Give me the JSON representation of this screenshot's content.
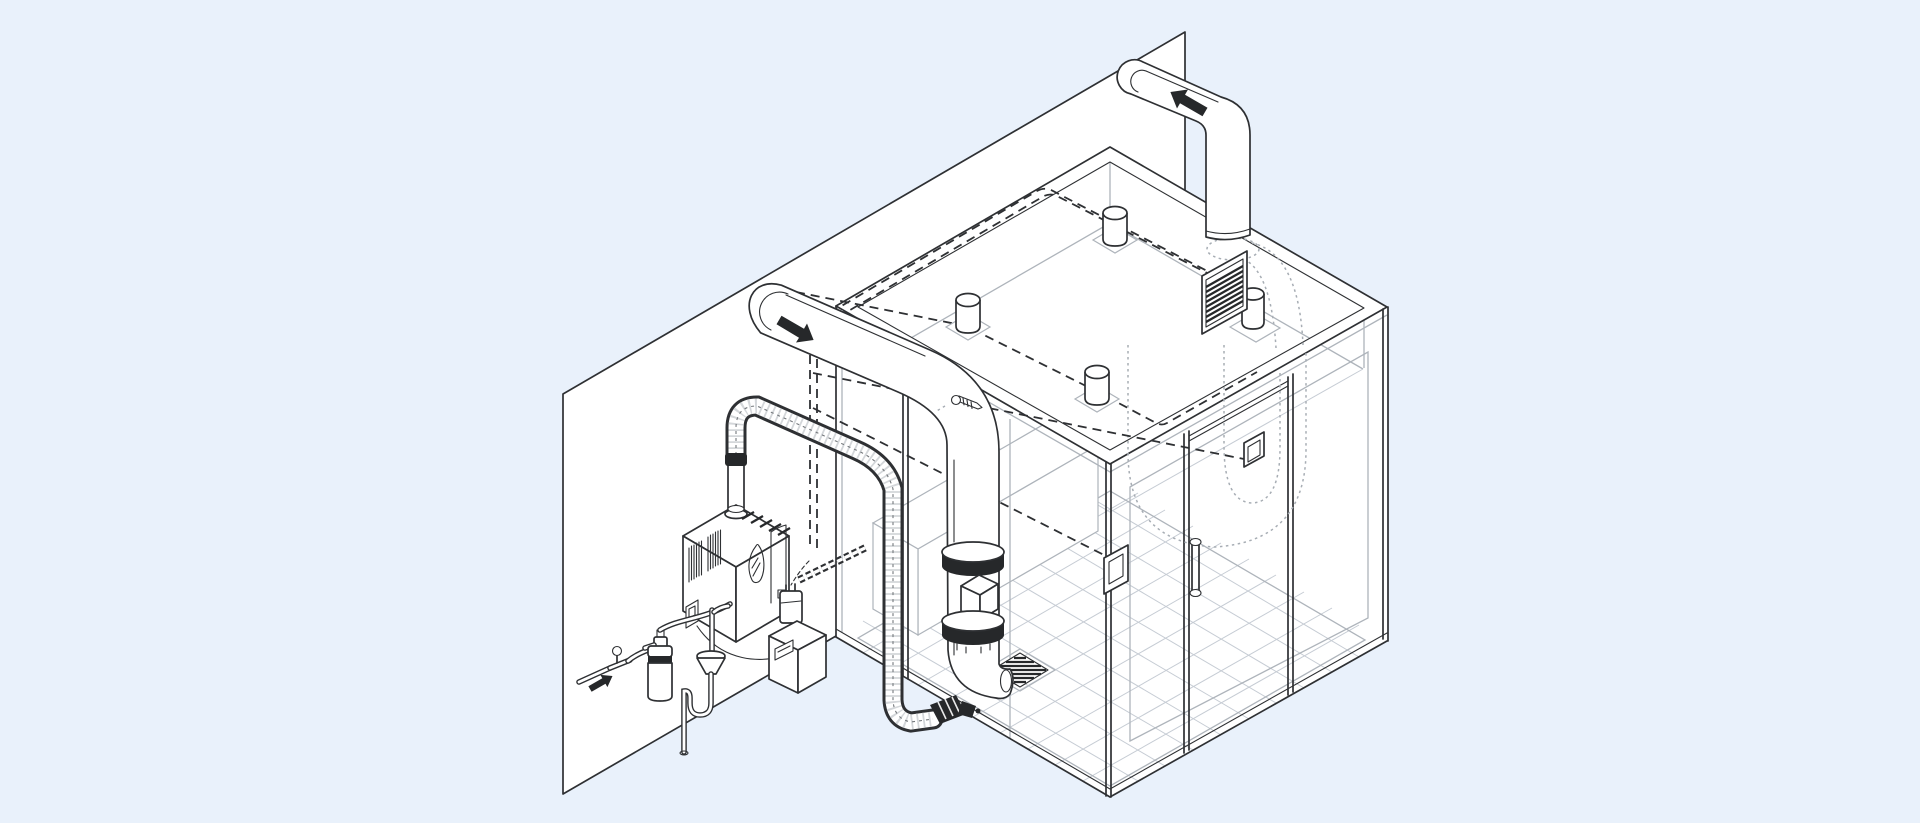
{
  "title": "Steam shower installation - isometric cutaway diagram",
  "theme": {
    "bg": "#e9f1fb",
    "paper": "#ffffff",
    "line": "#2e3033",
    "dark": "#26282a",
    "gray": "#aeb4bb",
    "gray2": "#c6ccd4",
    "ghost": "#a7adb4"
  },
  "components": {
    "background": {
      "label": "Light blue backdrop"
    },
    "wall": {
      "label": "Installation wall panel"
    },
    "steam_room": {
      "label": "Glass steam shower enclosure"
    },
    "rim": {
      "label": "Enclosure top rim"
    },
    "interior": {
      "label": "Enclosure interior with recessed ceiling"
    },
    "floor": {
      "label": "Tiled shower floor"
    },
    "floor_drain": {
      "label": "Floor drain grate"
    },
    "bench": {
      "label": "Shower bench"
    },
    "supply_duct": {
      "label": "Air supply duct with flanges"
    },
    "supply_arrow": {
      "label": "Airflow in",
      "direction": "down-right"
    },
    "exhaust_duct": {
      "label": "Exhaust duct over wall"
    },
    "exhaust_arrow": {
      "label": "Airflow out",
      "direction": "up-left"
    },
    "ghost_duct": {
      "label": "Concealed flexible duct loop (hidden run)"
    },
    "exhaust_grille": {
      "label": "Exhaust grille with collar"
    },
    "ceiling_fittings": {
      "label": "Ceiling duct fittings"
    },
    "cable_routes": {
      "label": "Concealed control cable routes"
    },
    "steam_generator": {
      "label": "Wall-mounted steam generator"
    },
    "steam_line": {
      "label": "Insulated flexible steam line"
    },
    "steam_head": {
      "label": "Steam head at floor level"
    },
    "water_filter": {
      "label": "Water filter cartridge"
    },
    "shutoff_valve": {
      "label": "Water shut-off valve"
    },
    "water_supply": {
      "label": "Cold water supply",
      "direction": "up-right"
    },
    "drain_funnel": {
      "label": "Air-gap drain funnel with trap"
    },
    "transformer": {
      "label": "Plug-in transformer"
    },
    "control_module": {
      "label": "Control module"
    },
    "power_conduit": {
      "label": "Flexible power conduit"
    },
    "keypad": {
      "label": "In-shower control keypad"
    },
    "door_handle": {
      "label": "Glass door handle"
    },
    "door_module": {
      "label": "Door-mounted hinge module"
    },
    "mounting_screw": {
      "label": "Mounting screw detail"
    }
  }
}
